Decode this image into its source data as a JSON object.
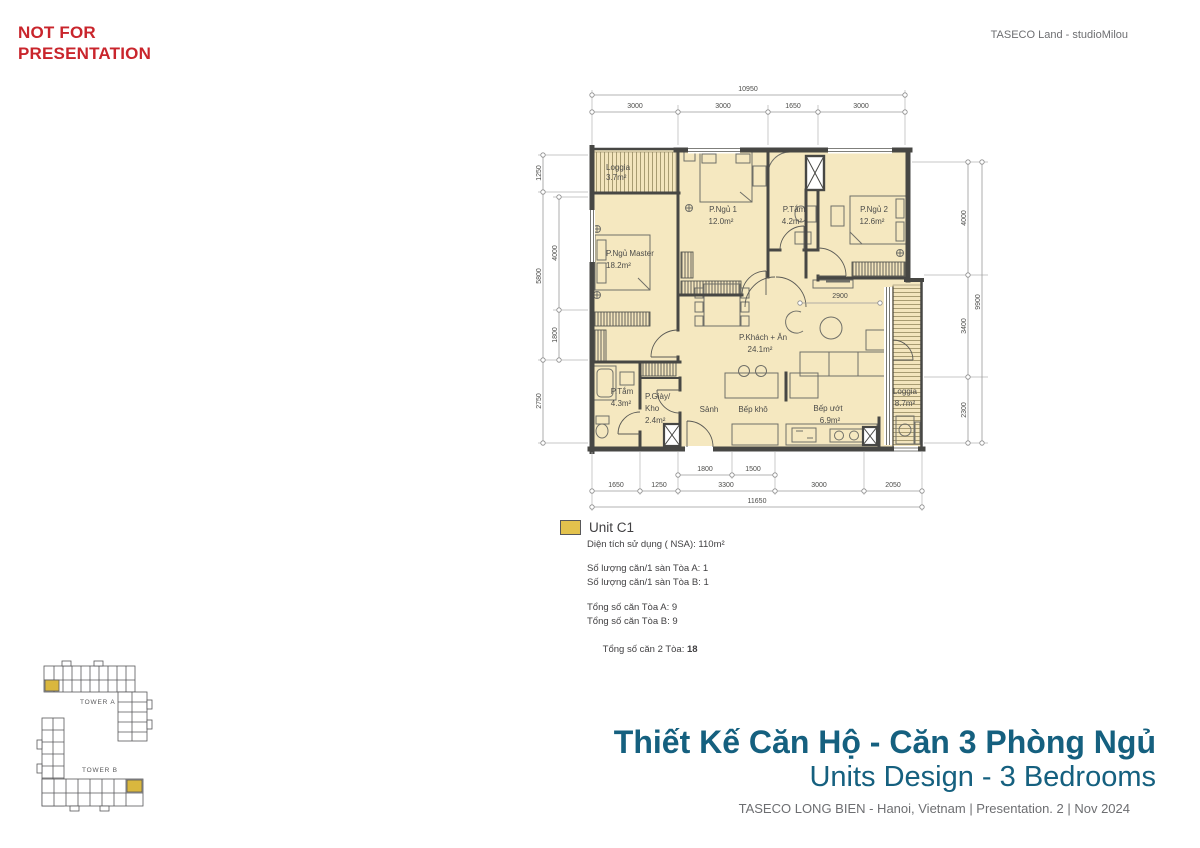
{
  "watermark": {
    "line1": "NOT FOR",
    "line2": "PRESENTATION"
  },
  "header": {
    "credit": "TASECO Land - studioMilou"
  },
  "plan": {
    "rooms": {
      "loggia_top": {
        "name": "Loggia",
        "area": "3.7m²"
      },
      "master": {
        "name": "P.Ngủ Master",
        "area": "18.2m²"
      },
      "bed1": {
        "name": "P.Ngủ 1",
        "area": "12.0m²"
      },
      "bath1": {
        "name": "P.Tắm",
        "area": "4.2m²"
      },
      "bed2": {
        "name": "P.Ngủ 2",
        "area": "12.6m²"
      },
      "living": {
        "name": "P.Khách + Ăn",
        "area": "24.1m²"
      },
      "bath2": {
        "name": "P.Tắm",
        "area": "4.3m²"
      },
      "shoe": {
        "line1": "P.Giày/",
        "line2": "Kho",
        "area": "2.4m²"
      },
      "hall": {
        "name": "Sảnh"
      },
      "kitchen_dry": {
        "name": "Bếp khô"
      },
      "kitchen_wet": {
        "name": "Bếp ướt",
        "area": "6.9m²"
      },
      "loggia_right": {
        "name": "Loggia",
        "area": "8.7m²"
      }
    },
    "dims": {
      "top_total": "10950",
      "top": [
        "3000",
        "3000",
        "1650",
        "3000"
      ],
      "left_outer": [
        "1250",
        "5800",
        "2750"
      ],
      "left_inner": [
        "4000",
        "1800"
      ],
      "right_inner": [
        "4000",
        "3400",
        "2300"
      ],
      "right_outer": "9900",
      "living_width": "2900",
      "bottom_upper": [
        "1800",
        "1500"
      ],
      "bottom": [
        "1650",
        "1250",
        "3300",
        "3000",
        "2050"
      ],
      "bottom_total": "11650"
    }
  },
  "legend": {
    "unit": "Unit C1",
    "nsa": "Diện tích sử dụng ( NSA): 110m²",
    "per_floor": [
      "Số lượng căn/1 sàn Tòa A: 1",
      "Số lượng căn/1 sàn Tòa B: 1"
    ],
    "totals": [
      "Tổng số căn Tòa A: 9",
      "Tổng số căn Tòa B: 9"
    ],
    "grand_total_label": "Tổng số căn 2 Tòa: ",
    "grand_total_value": "18"
  },
  "site": {
    "tower_a": "TOWER A",
    "tower_b": "TOWER B"
  },
  "footer": {
    "title_vi": "Thiết Kế Căn Hộ - Căn 3 Phòng Ngủ",
    "title_en": "Units Design - 3 Bedrooms",
    "credit": "TASECO LONG BIEN - Hanoi, Vietnam | Presentation. 2 | Nov 2024"
  },
  "colors": {
    "accent_red": "#c9252c",
    "title_blue": "#15607f",
    "floor_fill": "#f5e8c0",
    "wall": "#474744",
    "unit_gold": "#e3c24d"
  }
}
